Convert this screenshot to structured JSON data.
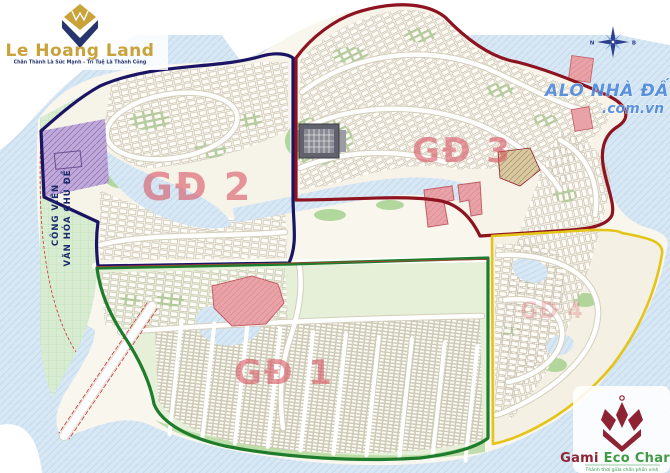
{
  "branding": {
    "le_hoang_land": {
      "name": "Le Hoang Land",
      "tagline": "Chân Thành Là Sức Mạnh - Trí Tuệ Là Thành Công"
    },
    "alo_nha_dat": {
      "line1": "ALO NHÀ ĐẤT",
      "line2": ".com.vn"
    },
    "gami": {
      "name_accent": "Gami",
      "name_rest": " Eco Charm",
      "tagline": "Thảnh thơi giữa chốn phồn vinh"
    }
  },
  "compass": {
    "left_label": "N",
    "right_label": "B"
  },
  "map": {
    "park_label_line1": "CÔNG VIÊN",
    "park_label_line2": "VĂN HÓA CHỦ ĐỀ",
    "label_color": "#d8515f",
    "water_color": "#d7e7f4",
    "park_color": "#d8ecd2",
    "zones": [
      {
        "id": "gd1",
        "label": "GĐ 1",
        "border_color": "#1e7d2c"
      },
      {
        "id": "gd2",
        "label": "GĐ 2",
        "border_color": "#1b1464"
      },
      {
        "id": "gd3",
        "label": "GĐ 3",
        "border_color": "#8e1320"
      },
      {
        "id": "gd4",
        "label": "GĐ 4",
        "border_color": "#e3c417"
      }
    ]
  }
}
